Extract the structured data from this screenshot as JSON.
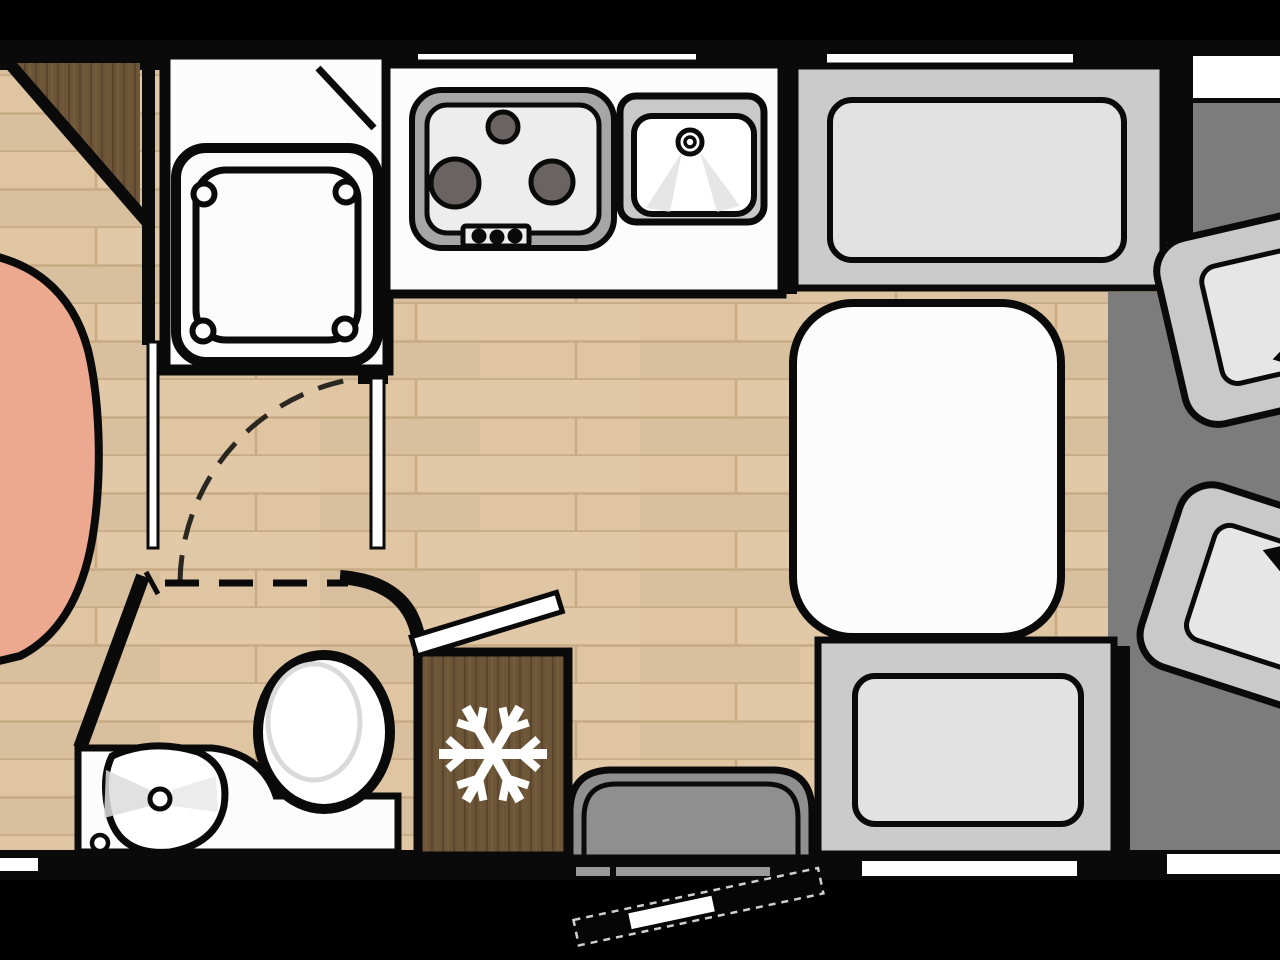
{
  "image": {
    "type": "motorhome-floorplan-top-view",
    "width_px": 1280,
    "height_px": 960,
    "visible_text": ""
  },
  "colors": {
    "background": "#000000",
    "wall": "#0a0a0a",
    "floor_wood": "#dfc5a2",
    "floor_plank_line": "#c8ab85",
    "dark_wood": "#6d5538",
    "dark_wood_grain": "#57412a",
    "dark_wood_grain_light": "#7b6244",
    "cab_floor": "#7c7c7c",
    "bench_base": "#cbcbcb",
    "bench_cushion": "#e2e2e2",
    "seat_base": "#c9c9c9",
    "seat_cushion": "#e6e6e6",
    "rear_seat_back": "#8f8f8f",
    "step_gray": "#9a9a9a",
    "fixture_white": "#fcfcfc",
    "hob_rim": "#a6a6a6",
    "hob_surface": "#ededed",
    "burner": "#696361",
    "sink_rim": "#c9c9c9",
    "water_shade": "#dcdcdc",
    "toilet_shade": "#dadada",
    "bed": "#eda98f",
    "window_white": "#ffffff",
    "door_dash": "#cfcfcf",
    "open_door_leaf": "#060606"
  },
  "rooms": {
    "bathroom_front": {
      "label": "shower room",
      "fixtures": [
        "shower-tray",
        "sliding-door",
        "corner-wardrobe"
      ]
    },
    "washroom_rear": {
      "label": "washroom",
      "fixtures": [
        "wash-basin",
        "toilet",
        "door-swing-arc"
      ]
    },
    "kitchen": {
      "label": "kitchen",
      "fixtures": [
        "gas-hob",
        "sink",
        "refrigerator"
      ]
    },
    "lounge": {
      "label": "dinette",
      "fixtures": [
        "table",
        "bench-front",
        "bench-rear",
        "rear-seat"
      ]
    },
    "cab": {
      "label": "driver cab",
      "fixtures": [
        "swivel-seat-1",
        "swivel-seat-2"
      ]
    },
    "bedroom": {
      "label": "bed (partially visible)",
      "fixtures": [
        "bed"
      ]
    }
  },
  "fixtures": {
    "gas_hob": {
      "burner_count": 3,
      "knob_count": 3
    },
    "shower_tray": {
      "corner_circle_count": 4
    },
    "swivel_seats": {
      "count": 2,
      "icon": "rotation-arrow"
    },
    "refrigerator": {
      "icon": "snowflake"
    },
    "windows_top_wall": 2,
    "entry_door": {
      "state": "open",
      "outline": "dashed"
    }
  }
}
